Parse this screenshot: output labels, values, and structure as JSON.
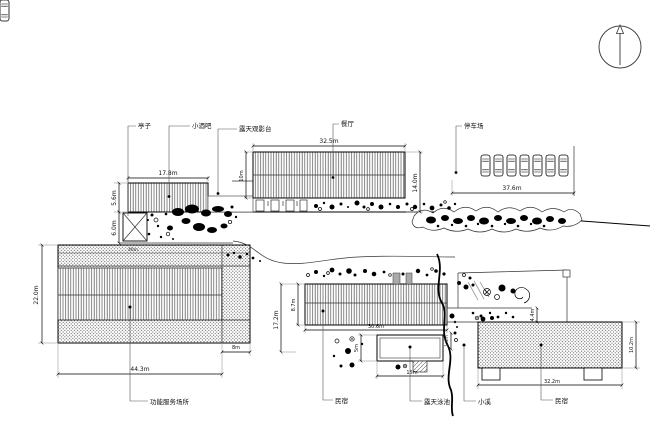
{
  "labels": {
    "pavilion": "亭子",
    "bar": "小酒吧",
    "stage": "露天观影台",
    "restaurant": "餐厅",
    "parking": "停车场",
    "service": "功能服务场所",
    "guesthouse_mid": "民宿",
    "pool": "露天泳池",
    "stream": "小溪",
    "guesthouse_right": "民宿"
  },
  "dimensions": {
    "bar_width": "17.8m",
    "bar_height": "5.6m",
    "bar_gap": "6.0m",
    "restaurant_width": "32.5m",
    "restaurant_height_left": "10m",
    "restaurant_height_right": "14.0m",
    "parking_width": "37.6m",
    "service_height": "22.0m",
    "service_width": "44.3m",
    "service_ext": "8m",
    "service_inner": "46m",
    "gh_mid_height": "8.7m",
    "gh_mid_total": "17.2m",
    "gh_mid_width": "30.6m",
    "pool_width": "5m",
    "pool_length": "15m",
    "stream_width": "1.4m",
    "terrace_height": "4.4m",
    "gh_right_width": "32.2m",
    "gh_right_height": "10.2m"
  }
}
